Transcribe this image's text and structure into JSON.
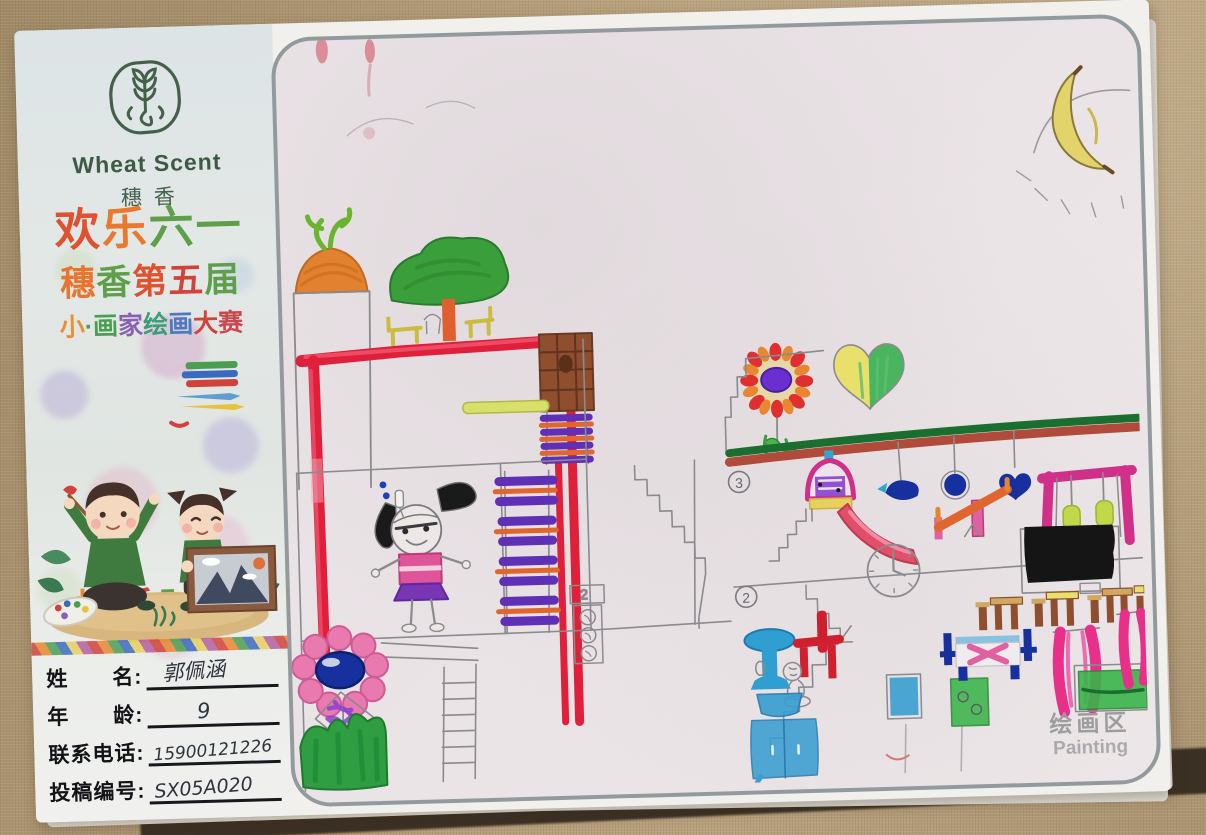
{
  "branding": {
    "logo_en": "Wheat Scent",
    "logo_cn": "穗香",
    "logo_color": "#44604a"
  },
  "poster": {
    "lines": [
      {
        "chars": [
          {
            "ch": "欢",
            "color": "#e0512f"
          },
          {
            "ch": "乐",
            "color": "#e8792f"
          },
          {
            "ch": "六",
            "color": "#5f9e4a"
          },
          {
            "ch": "一",
            "color": "#5f9e4a"
          }
        ]
      },
      {
        "chars": [
          {
            "ch": "穗",
            "color": "#e8742f"
          },
          {
            "ch": "香",
            "color": "#5f9e4a"
          },
          {
            "ch": "第",
            "color": "#e0512f"
          },
          {
            "ch": "五",
            "color": "#d0423a"
          },
          {
            "ch": "届",
            "color": "#5f9e4a"
          }
        ]
      },
      {
        "chars": [
          {
            "ch": "小",
            "color": "#e8922f"
          },
          {
            "ch": "·",
            "color": "#4a9e52"
          },
          {
            "ch": "画",
            "color": "#4a9e52"
          },
          {
            "ch": "家",
            "color": "#8a5fb5"
          },
          {
            "ch": "绘",
            "color": "#3a9e7a"
          },
          {
            "ch": "画",
            "color": "#4a7ac0"
          },
          {
            "ch": "大",
            "color": "#d0423a"
          },
          {
            "ch": "赛",
            "color": "#c9474f"
          }
        ]
      },
      {
        "chars": [
          {
            "ch": "快",
            "color": "#e8872f"
          },
          {
            "ch": "乐",
            "color": "#d0423a"
          },
          {
            "ch": "时",
            "color": "#5f9e4a"
          },
          {
            "ch": "光",
            "color": "#4a9e52"
          }
        ]
      }
    ]
  },
  "entry_form": {
    "fields": [
      {
        "label": "姓　　名:",
        "value": "郭佩涵"
      },
      {
        "label": "年　　龄:",
        "value": "9"
      },
      {
        "label": "联系电话:",
        "value": "15900121226"
      },
      {
        "label": "投稿编号:",
        "value": "SX05A020"
      }
    ]
  },
  "drawing_area": {
    "floor_label_3": "3",
    "floor_label_2": "2",
    "elevator_label": "2",
    "watermark_cn": "绘画区",
    "watermark_en": "Painting"
  },
  "palette": {
    "marker_red": "#e01f3a",
    "marker_pink": "#e82f8a",
    "marker_purple": "#5f2fb5",
    "marker_blue": "#16309e",
    "marker_cyan": "#2f9ed0",
    "marker_green": "#3ab54a",
    "marker_orange": "#e0662f",
    "marker_brown": "#8f4f2f",
    "marker_yellow": "#d8e06a",
    "paper": "#f2f0ec",
    "fabric": "#b29a77"
  }
}
